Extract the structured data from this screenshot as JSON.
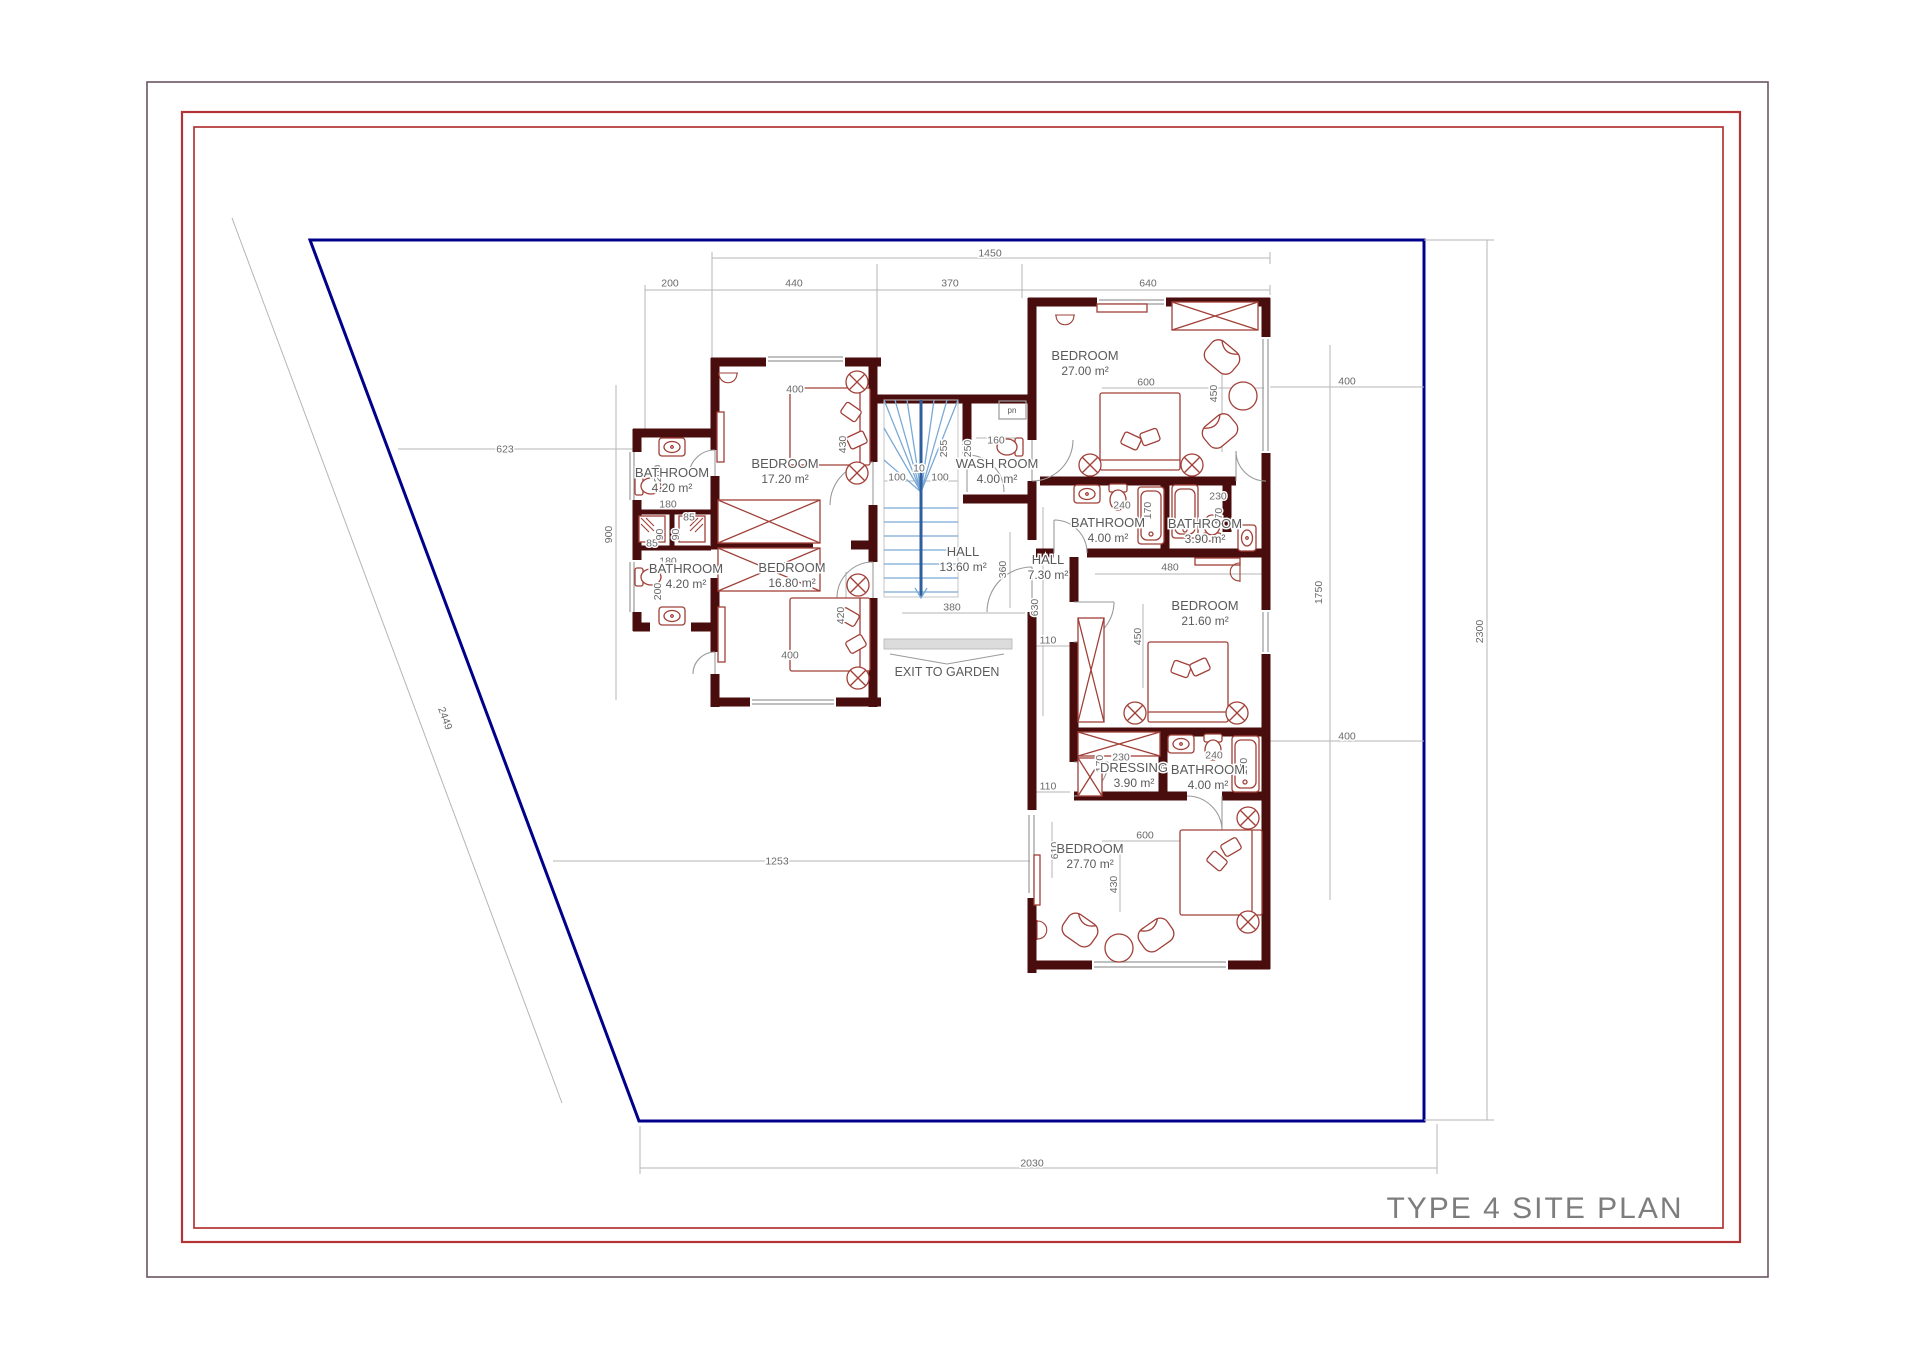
{
  "title": "TYPE 4 SITE PLAN",
  "colors": {
    "frame_outer": "#6b5560",
    "frame_red": "#b23434",
    "boundary_blue": "#00008b",
    "wall_maroon": "#4a0d0d",
    "furniture_red": "#a04038",
    "stair_blue": "#7aa9d6",
    "stair_center_blue": "#2f5e9e",
    "dim_line_gray": "#b5b5b5",
    "dim_text_gray": "#6a6a6a",
    "room_text_gray": "#5a5a5a",
    "door_gray": "#9a9a9a",
    "window_gray": "#9a9a9a",
    "title_gray": "#7d7d7d"
  },
  "rooms": [
    {
      "name": "BEDROOM",
      "area": "17.20 m²",
      "x": 785,
      "y": 468
    },
    {
      "name": "BEDROOM",
      "area": "16.80 m²",
      "x": 792,
      "y": 572
    },
    {
      "name": "BATHROOM",
      "area": "4.20 m²",
      "x": 672,
      "y": 477
    },
    {
      "name": "BATHROOM",
      "area": "4.20 m²",
      "x": 686,
      "y": 573
    },
    {
      "name": "HALL",
      "area": "13.60 m²",
      "x": 963,
      "y": 556
    },
    {
      "name": "WASH ROOM",
      "area": "4.00 m²",
      "x": 997,
      "y": 468
    },
    {
      "name": "HALL",
      "area": "7.30 m²",
      "x": 1048,
      "y": 564
    },
    {
      "name": "BEDROOM",
      "area": "27.00 m²",
      "x": 1085,
      "y": 360
    },
    {
      "name": "BATHROOM",
      "area": "4.00 m²",
      "x": 1108,
      "y": 527
    },
    {
      "name": "BATHROOM",
      "area": "3.90 m²",
      "x": 1205,
      "y": 528
    },
    {
      "name": "BEDROOM",
      "area": "21.60 m²",
      "x": 1205,
      "y": 610
    },
    {
      "name": "DRESSING",
      "area": "3.90 m²",
      "x": 1134,
      "y": 772
    },
    {
      "name": "BATHROOM",
      "area": "4.00 m²",
      "x": 1208,
      "y": 774
    },
    {
      "name": "BEDROOM",
      "area": "27.70 m²",
      "x": 1090,
      "y": 853
    }
  ],
  "dimensions": [
    {
      "v": "1450",
      "x": 990,
      "y": 253,
      "r": 0
    },
    {
      "v": "200",
      "x": 670,
      "y": 283,
      "r": 0
    },
    {
      "v": "440",
      "x": 794,
      "y": 283,
      "r": 0
    },
    {
      "v": "370",
      "x": 950,
      "y": 283,
      "r": 0
    },
    {
      "v": "640",
      "x": 1148,
      "y": 283,
      "r": 0
    },
    {
      "v": "623",
      "x": 505,
      "y": 449,
      "r": 0
    },
    {
      "v": "900",
      "x": 612,
      "y": 531,
      "r": -90
    },
    {
      "v": "2449",
      "x": 442,
      "y": 716,
      "r": 70
    },
    {
      "v": "1253",
      "x": 777,
      "y": 861,
      "r": 0
    },
    {
      "v": "2030",
      "x": 1032,
      "y": 1163,
      "r": 0
    },
    {
      "v": "2300",
      "x": 1483,
      "y": 628,
      "r": -90
    },
    {
      "v": "1750",
      "x": 1322,
      "y": 589,
      "r": -90
    },
    {
      "v": "400",
      "x": 1347,
      "y": 381,
      "r": 0
    },
    {
      "v": "400",
      "x": 1347,
      "y": 736,
      "r": 0
    },
    {
      "v": "400",
      "x": 795,
      "y": 389,
      "r": 0
    },
    {
      "v": "430",
      "x": 846,
      "y": 441,
      "r": -90
    },
    {
      "v": "400",
      "x": 790,
      "y": 655,
      "r": 0
    },
    {
      "v": "420",
      "x": 844,
      "y": 612,
      "r": -90
    },
    {
      "v": "180",
      "x": 668,
      "y": 504,
      "r": 0
    },
    {
      "v": "200",
      "x": 661,
      "y": 470,
      "r": -90
    },
    {
      "v": "180",
      "x": 668,
      "y": 561,
      "r": 0
    },
    {
      "v": "200",
      "x": 661,
      "y": 588,
      "r": -90
    },
    {
      "v": "85",
      "x": 652,
      "y": 543,
      "r": 0
    },
    {
      "v": "90",
      "x": 663,
      "y": 531,
      "r": -90
    },
    {
      "v": "85",
      "x": 689,
      "y": 517,
      "r": 0
    },
    {
      "v": "90",
      "x": 679,
      "y": 531,
      "r": -90
    },
    {
      "v": "100",
      "x": 897,
      "y": 477,
      "r": 0
    },
    {
      "v": "10",
      "x": 919,
      "y": 468,
      "r": 0
    },
    {
      "v": "100",
      "x": 940,
      "y": 477,
      "r": 0
    },
    {
      "v": "255",
      "x": 947,
      "y": 445,
      "r": -90
    },
    {
      "v": "250",
      "x": 971,
      "y": 445,
      "r": -90
    },
    {
      "v": "160",
      "x": 996,
      "y": 440,
      "r": 0
    },
    {
      "v": "380",
      "x": 952,
      "y": 607,
      "r": 0
    },
    {
      "v": "360",
      "x": 1006,
      "y": 566,
      "r": -90
    },
    {
      "v": "630",
      "x": 1038,
      "y": 604,
      "r": -90
    },
    {
      "v": "110",
      "x": 1048,
      "y": 640,
      "r": 0
    },
    {
      "v": "110",
      "x": 1048,
      "y": 786,
      "r": 0
    },
    {
      "v": "600",
      "x": 1146,
      "y": 382,
      "r": 0
    },
    {
      "v": "450",
      "x": 1217,
      "y": 390,
      "r": -90
    },
    {
      "v": "240",
      "x": 1122,
      "y": 505,
      "r": 0
    },
    {
      "v": "170",
      "x": 1151,
      "y": 507,
      "r": -90
    },
    {
      "v": "230",
      "x": 1218,
      "y": 496,
      "r": 0
    },
    {
      "v": "170",
      "x": 1222,
      "y": 513,
      "r": -90
    },
    {
      "v": "480",
      "x": 1170,
      "y": 567,
      "r": 0
    },
    {
      "v": "450",
      "x": 1141,
      "y": 633,
      "r": -90
    },
    {
      "v": "230",
      "x": 1121,
      "y": 757,
      "r": 0
    },
    {
      "v": "170",
      "x": 1103,
      "y": 760,
      "r": -90
    },
    {
      "v": "240",
      "x": 1214,
      "y": 755,
      "r": 0
    },
    {
      "v": "170",
      "x": 1247,
      "y": 763,
      "r": -90
    },
    {
      "v": "600",
      "x": 1145,
      "y": 835,
      "r": 0
    },
    {
      "v": "610",
      "x": 1058,
      "y": 847,
      "r": -90
    },
    {
      "v": "430",
      "x": 1117,
      "y": 881,
      "r": -90
    }
  ],
  "annotations": [
    {
      "text": "EXIT TO GARDEN",
      "x": 947,
      "y": 676,
      "size": 12.5
    },
    {
      "text": "pn",
      "x": 1012,
      "y": 413,
      "size": 8
    }
  ]
}
